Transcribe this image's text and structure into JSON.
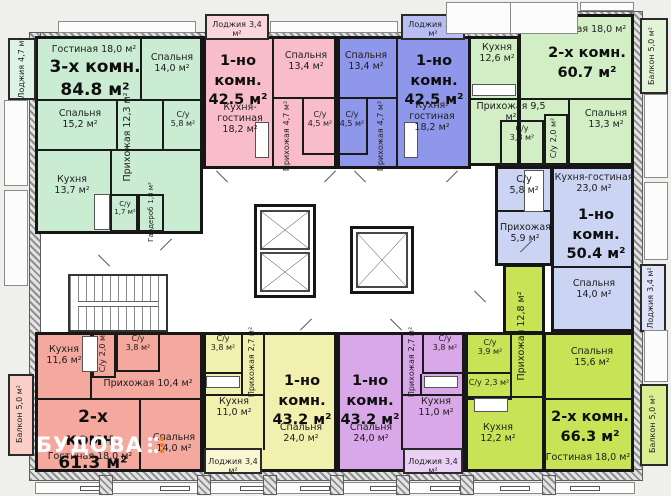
{
  "watermark": {
    "text": "БУДОВА",
    "text_color": "#ffffff",
    "accent_color": "#f07a1e"
  },
  "plan_colors": {
    "wall": "#161616",
    "common_area": "#ffffff",
    "background": "#efefec"
  },
  "apartments": {
    "a1": {
      "title": "3-х комн.",
      "area": "84.8 м²",
      "color": "#c9ecd3",
      "light": "#def3e5",
      "rooms": {
        "loggia": {
          "name": "Лоджия",
          "area": "4,7 м²"
        },
        "gostinaya": {
          "name": "Гостиная",
          "area": "18,0 м²"
        },
        "spalnya_1": {
          "name": "Спальня",
          "area": "14,0 м²"
        },
        "spalnya_2": {
          "name": "Спальня",
          "area": "15,2 м²"
        },
        "prihozhaya": {
          "name": "Прихожая",
          "area": "12,3 м²"
        },
        "su_1": {
          "name": "С/у",
          "area": "5,8 м²"
        },
        "kuhnya": {
          "name": "Кухня",
          "area": "13,7 м²"
        },
        "su_2": {
          "name": "С/у",
          "area": "1,7 м²"
        },
        "garderob": {
          "name": "Гардероб",
          "area": "1,8 м²"
        }
      }
    },
    "a2": {
      "title": "1-но комн.",
      "area": "42.5 м²",
      "color": "#f9bdc9",
      "light": "#fbd6dd",
      "rooms": {
        "loggia": {
          "name": "Лоджия",
          "area": "3,4 м²"
        },
        "spalnya": {
          "name": "Спальня",
          "area": "13,4 м²"
        },
        "kuhnya_gostinaya": {
          "name": "Кухня-гостиная",
          "area": "18,2 м²"
        },
        "prihozhaya": {
          "name": "Прихожая",
          "area": "4,7 м²"
        },
        "su": {
          "name": "С/у",
          "area": "4,5 м²"
        }
      }
    },
    "a3": {
      "title": "1-но комн.",
      "area": "42.5 м²",
      "color": "#8e97e9",
      "light": "#b9bef2",
      "rooms": {
        "loggia": {
          "name": "Лоджия",
          "area": "3,4 м²"
        },
        "spalnya": {
          "name": "Спальня",
          "area": "13,4 м²"
        },
        "kuhnya_gostinaya": {
          "name": "Кухня-гостиная",
          "area": "18,2 м²"
        },
        "prihozhaya": {
          "name": "Прихожая",
          "area": "4,7 м²"
        },
        "su": {
          "name": "С/у",
          "area": "4,5 м²"
        }
      }
    },
    "a4": {
      "title": "2-х комн.",
      "area": "60.7 м²",
      "color": "#d1eec5",
      "light": "#e3f5d8",
      "rooms": {
        "kuhnya": {
          "name": "Кухня",
          "area": "12,6 м²"
        },
        "gostinaya": {
          "name": "Гостиная",
          "area": "18,0 м²"
        },
        "balkon": {
          "name": "Балкон",
          "area": "5,0 м²"
        },
        "prihozhaya": {
          "name": "Прихожая",
          "area": "9,5 м²"
        },
        "su_1": {
          "name": "С/у",
          "area": "3,8 м²"
        },
        "su_2": {
          "name": "С/у",
          "area": "2,0 м²"
        },
        "spalnya": {
          "name": "Спальня",
          "area": "13,3 м²"
        }
      }
    },
    "a5": {
      "title": "1-но комн.",
      "area": "50.4 м²",
      "color": "#ccd4f3",
      "light": "#dfe4f9",
      "rooms": {
        "su": {
          "name": "С/у",
          "area": "5,8 м²"
        },
        "kuhnya_gostinaya": {
          "name": "Кухня-гостиная",
          "area": "23,0 м²"
        },
        "prihozhaya": {
          "name": "Прихожая",
          "area": "5,9 м²"
        },
        "spalnya": {
          "name": "Спальня",
          "area": "14,0 м²"
        },
        "loggia": {
          "name": "Лоджия",
          "area": "3,4 м²"
        }
      }
    },
    "a6": {
      "title": "2-х комн.",
      "area": "66.3 м²",
      "color": "#c8e356",
      "light": "#dcee92",
      "rooms": {
        "prihozhaya": {
          "name": "Прихожая",
          "area": "12,8 м²"
        },
        "su_1": {
          "name": "С/у",
          "area": "3,9 м²"
        },
        "su_2": {
          "name": "С/у",
          "area": "2,3 м²"
        },
        "spalnya": {
          "name": "Спальня",
          "area": "15,6 м²"
        },
        "kuhnya": {
          "name": "Кухня",
          "area": "12,2 м²"
        },
        "gostinaya": {
          "name": "Гостиная",
          "area": "18,0 м²"
        },
        "balkon": {
          "name": "Балкон",
          "area": "5,0 м²"
        }
      }
    },
    "a7": {
      "title": "1-но комн.",
      "area": "43.2 м²",
      "color": "#d9a8e9",
      "light": "#ead0f5",
      "rooms": {
        "su": {
          "name": "С/у",
          "area": "3,8 м²"
        },
        "prihozhaya": {
          "name": "Прихожая",
          "area": "2,7 м²"
        },
        "kuhnya": {
          "name": "Кухня",
          "area": "11,0 м²"
        },
        "spalnya": {
          "name": "Спальня",
          "area": "24,0 м²"
        },
        "loggia": {
          "name": "Лоджия",
          "area": "3,4 м²"
        }
      }
    },
    "a8": {
      "title": "1-но комн.",
      "area": "43.2 м²",
      "color": "#f2f0af",
      "light": "#f8f7d2",
      "rooms": {
        "su": {
          "name": "С/у",
          "area": "3,8 м²"
        },
        "prihozhaya": {
          "name": "Прихожая",
          "area": "2,7 м²"
        },
        "kuhnya": {
          "name": "Кухня",
          "area": "11,0 м²"
        },
        "spalnya": {
          "name": "Спальня",
          "area": "24,0 м²"
        },
        "loggia": {
          "name": "Лоджия",
          "area": "3,4 м²"
        }
      }
    },
    "a9": {
      "title": "2-х комн.",
      "area": "61.3 м²",
      "color": "#f4a89e",
      "light": "#f9cfc8",
      "rooms": {
        "kuhnya": {
          "name": "Кухня",
          "area": "11,6 м²"
        },
        "su_1": {
          "name": "С/у",
          "area": "2,0 м²"
        },
        "su_2": {
          "name": "С/у",
          "area": "3,8 м²"
        },
        "prihozhaya": {
          "name": "Прихожая",
          "area": "10,4 м²"
        },
        "gostinaya": {
          "name": "Гостиная",
          "area": "18,0 м²"
        },
        "spalnya": {
          "name": "Спальня",
          "area": "14,0 м²"
        },
        "balkon": {
          "name": "Балкон",
          "area": "5,0 м²"
        }
      }
    }
  }
}
